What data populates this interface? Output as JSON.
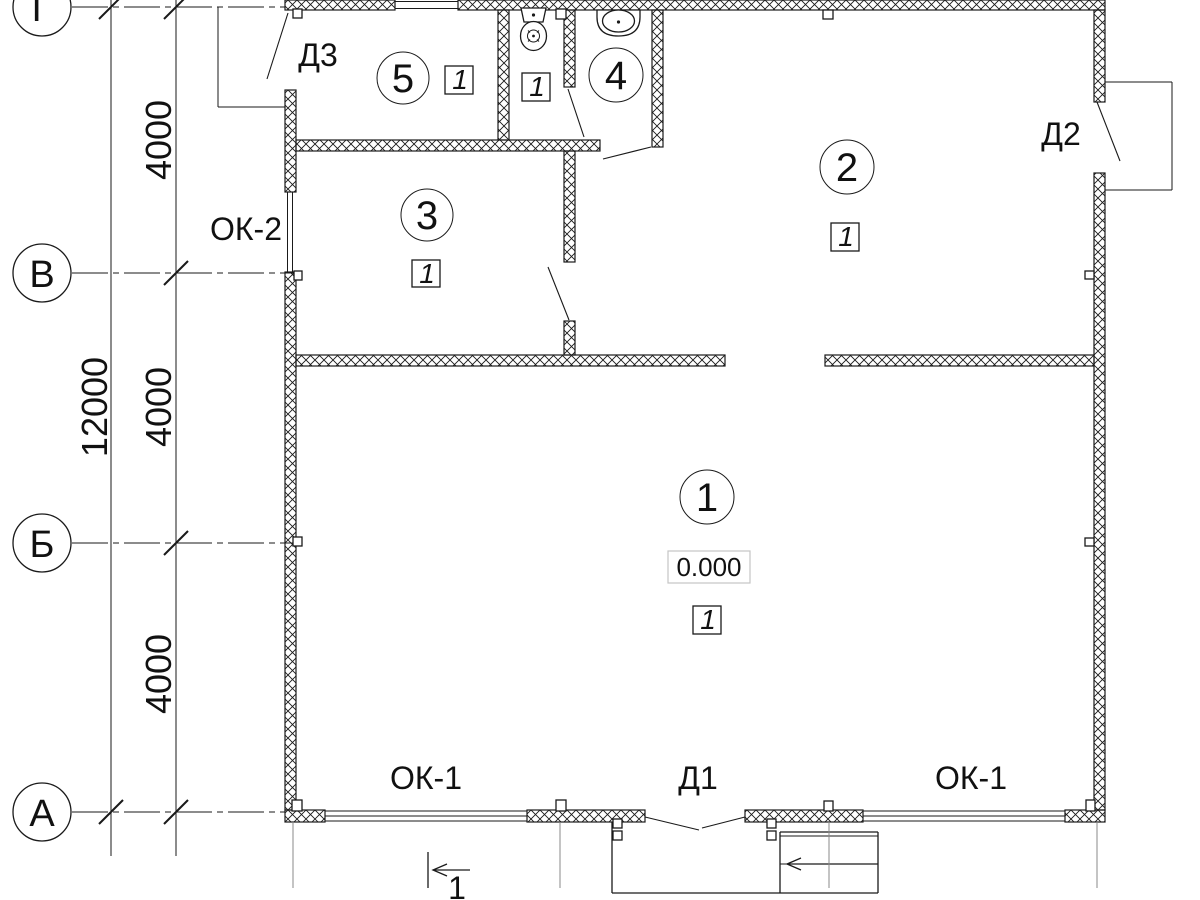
{
  "meta": {
    "drawing_type": "architectural floor plan",
    "background_color": "#ffffff",
    "line_color": "#1a1a1a",
    "elevation_box_border_color": "#c4c4c4"
  },
  "axes": {
    "horizontal": [
      {
        "label": "Г"
      },
      {
        "label": "В"
      },
      {
        "label": "Б"
      },
      {
        "label": "А"
      }
    ]
  },
  "dimensions": {
    "overall": "12000",
    "segments": [
      "4000",
      "4000",
      "4000"
    ]
  },
  "openings": {
    "doors": [
      {
        "label": "Д3"
      },
      {
        "label": "Д2"
      },
      {
        "label": "Д1"
      }
    ],
    "windows": [
      {
        "label": "ОК-2"
      },
      {
        "label": "ОК-1"
      },
      {
        "label": "ОК-1"
      }
    ]
  },
  "rooms": [
    {
      "number": "1",
      "floor_type": "1",
      "elevation": "0.000"
    },
    {
      "number": "2",
      "floor_type": "1"
    },
    {
      "number": "3",
      "floor_type": "1"
    },
    {
      "number": "4"
    },
    {
      "number": "5",
      "floor_type": "1"
    }
  ],
  "wc_floor_type": "1",
  "section_mark": {
    "number": "1"
  }
}
